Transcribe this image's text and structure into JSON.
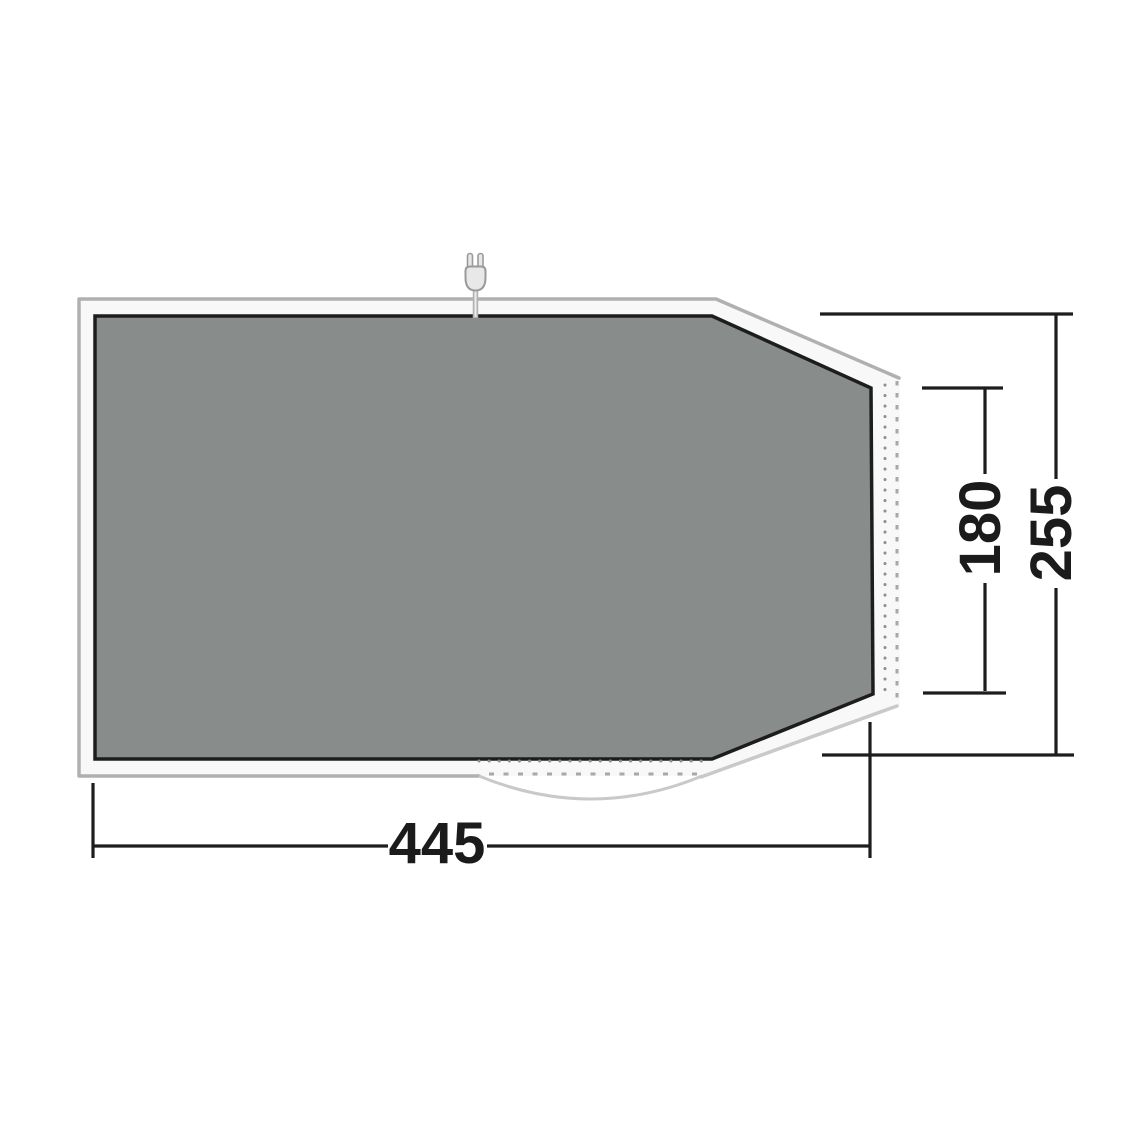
{
  "diagram": {
    "kind": "tent-footprint-dimension-diagram",
    "dimensions": {
      "width": {
        "value": "445",
        "orientation": "horizontal"
      },
      "rear_height": {
        "value": "180",
        "orientation": "vertical"
      },
      "total_height": {
        "value": "255",
        "orientation": "vertical"
      }
    },
    "icons": {
      "power_plug": "power-plug-icon"
    },
    "colors": {
      "background": "#ffffff",
      "groundsheet_fill": "#888d8b",
      "groundsheet_stroke": "#1d1d1d",
      "band_fill": "#f8f8f8",
      "band_stroke": "#b0b0b0",
      "light_stroke": "#c9c9c9",
      "zip_dots": "#8f8f8f",
      "zip_dashes": "#a8a8a8",
      "dimension_lines": "#1d1d1d",
      "plug_fill": "#e8e8e8",
      "plug_stroke": "#9a9a9a"
    }
  }
}
